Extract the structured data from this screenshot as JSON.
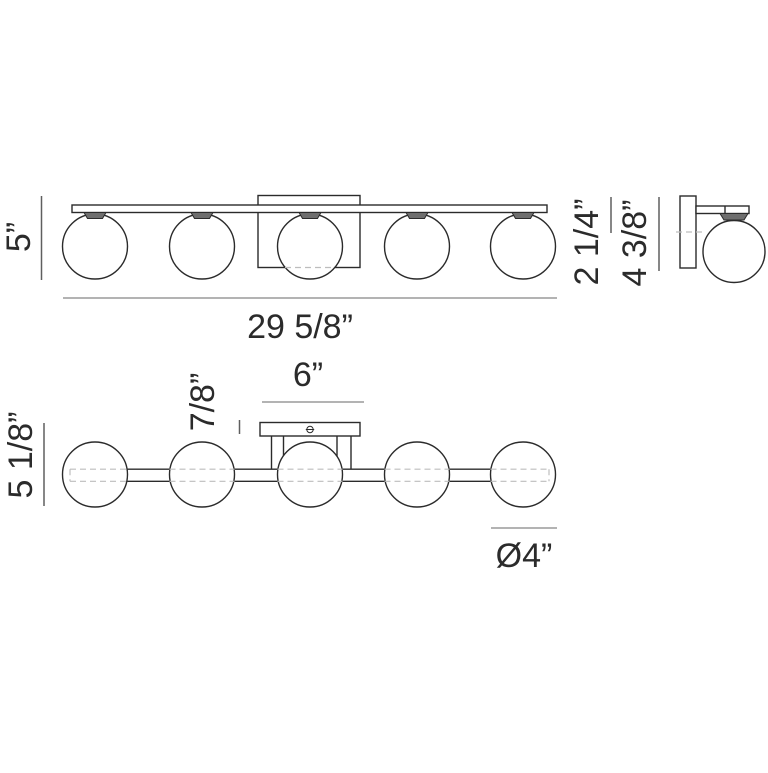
{
  "colors": {
    "background": "#ffffff",
    "line": "#2b2b2b",
    "text": "#2b2b2b",
    "socket_fill": "#6e6e6e",
    "hidden_line": "#bdbdbd",
    "dimension_line_dark": "#5f5f5f",
    "dimension_line_light": "#9a9a9a"
  },
  "drawing": {
    "front_view": {
      "height_label": "5”",
      "width_label": "29 5/8”",
      "projection_label": "2 1/4”",
      "backplate_label": "4 3/8”"
    },
    "bottom_view": {
      "depth_label": "5 1/8”",
      "canopy_thickness_label": "7/8”",
      "canopy_width_label": "6”",
      "globe_diameter_label": "Ø4”"
    }
  }
}
